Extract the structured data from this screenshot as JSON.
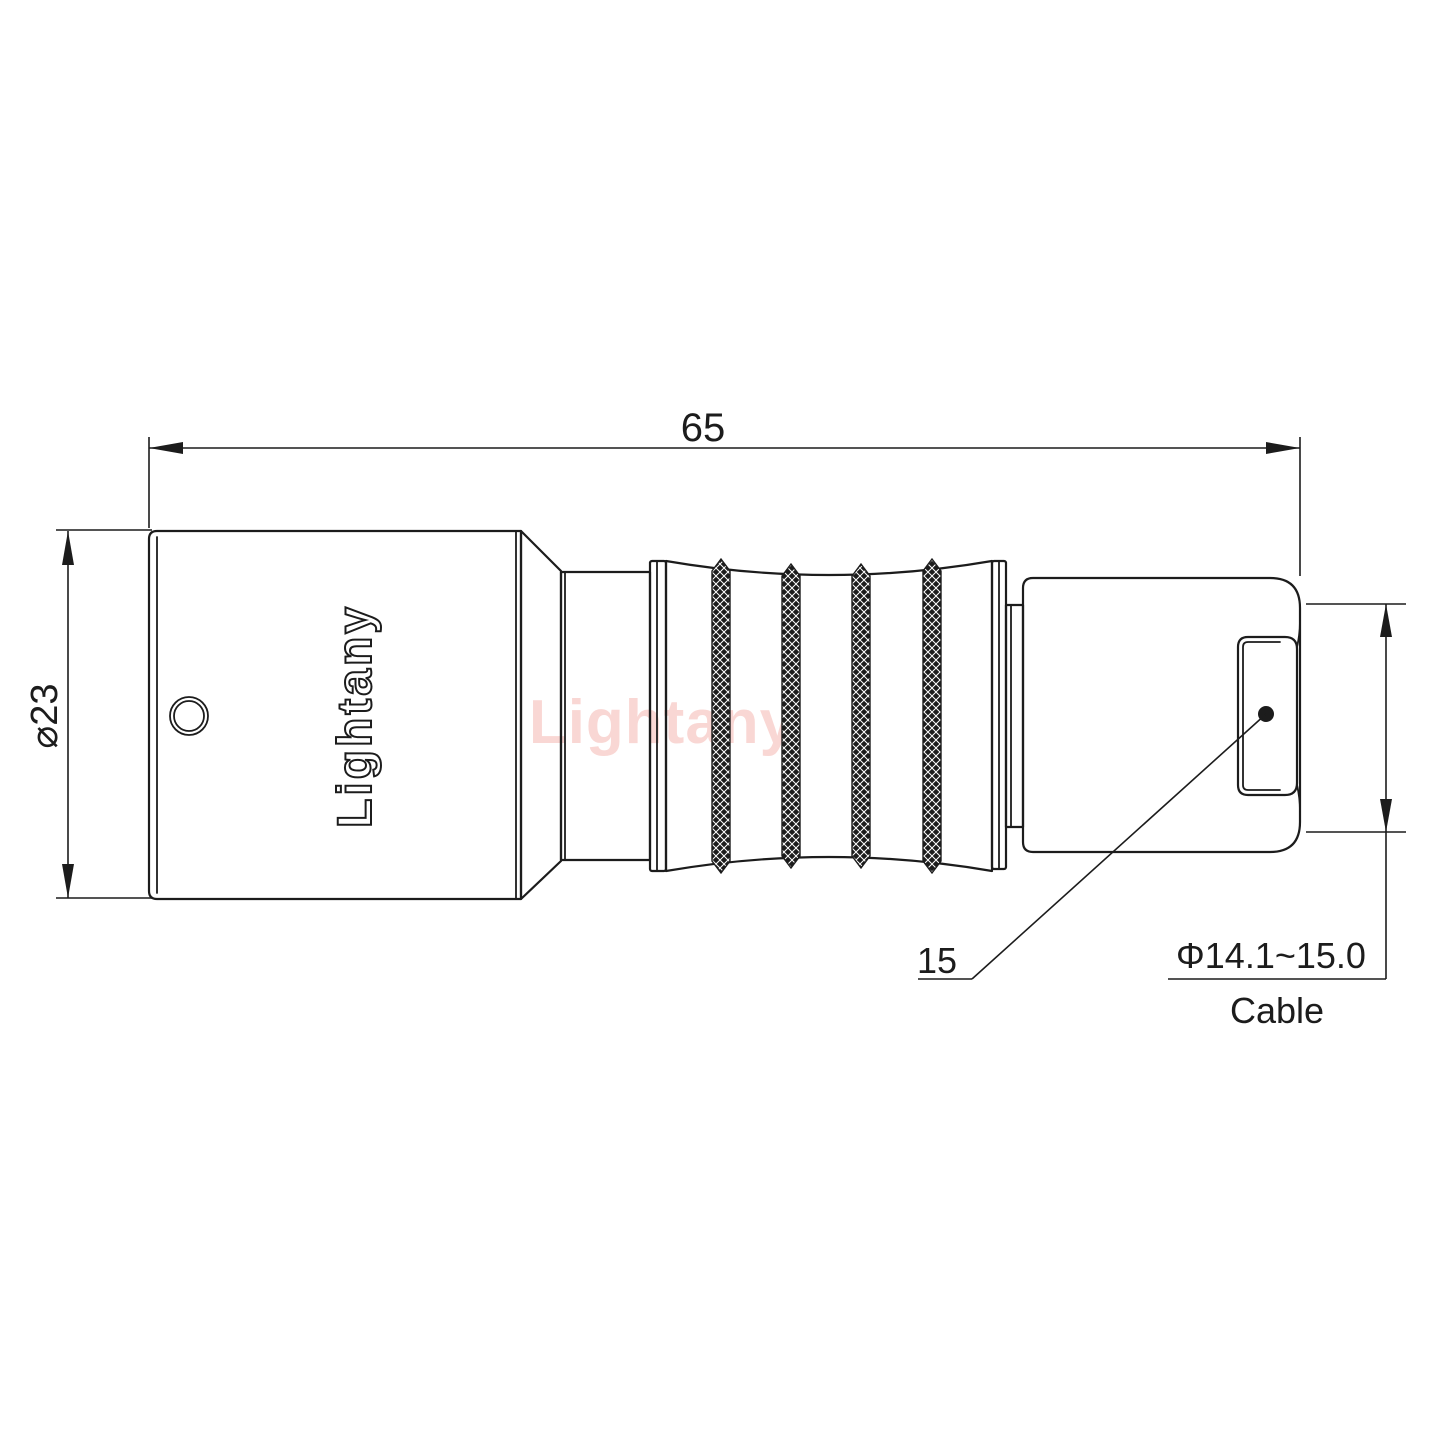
{
  "drawing": {
    "title": "Connector side-view technical drawing",
    "brand_engraved": "Lightany",
    "watermark": "Lightany",
    "dimensions": {
      "overall_length": "65",
      "body_diameter": "⌀23",
      "nut_length": "15",
      "cable_diameter_range": "Φ14.1~15.0",
      "cable_label": "Cable"
    },
    "colors": {
      "line": "#1c1c1c",
      "watermark": "#f5b7b1",
      "background": "#ffffff"
    }
  }
}
